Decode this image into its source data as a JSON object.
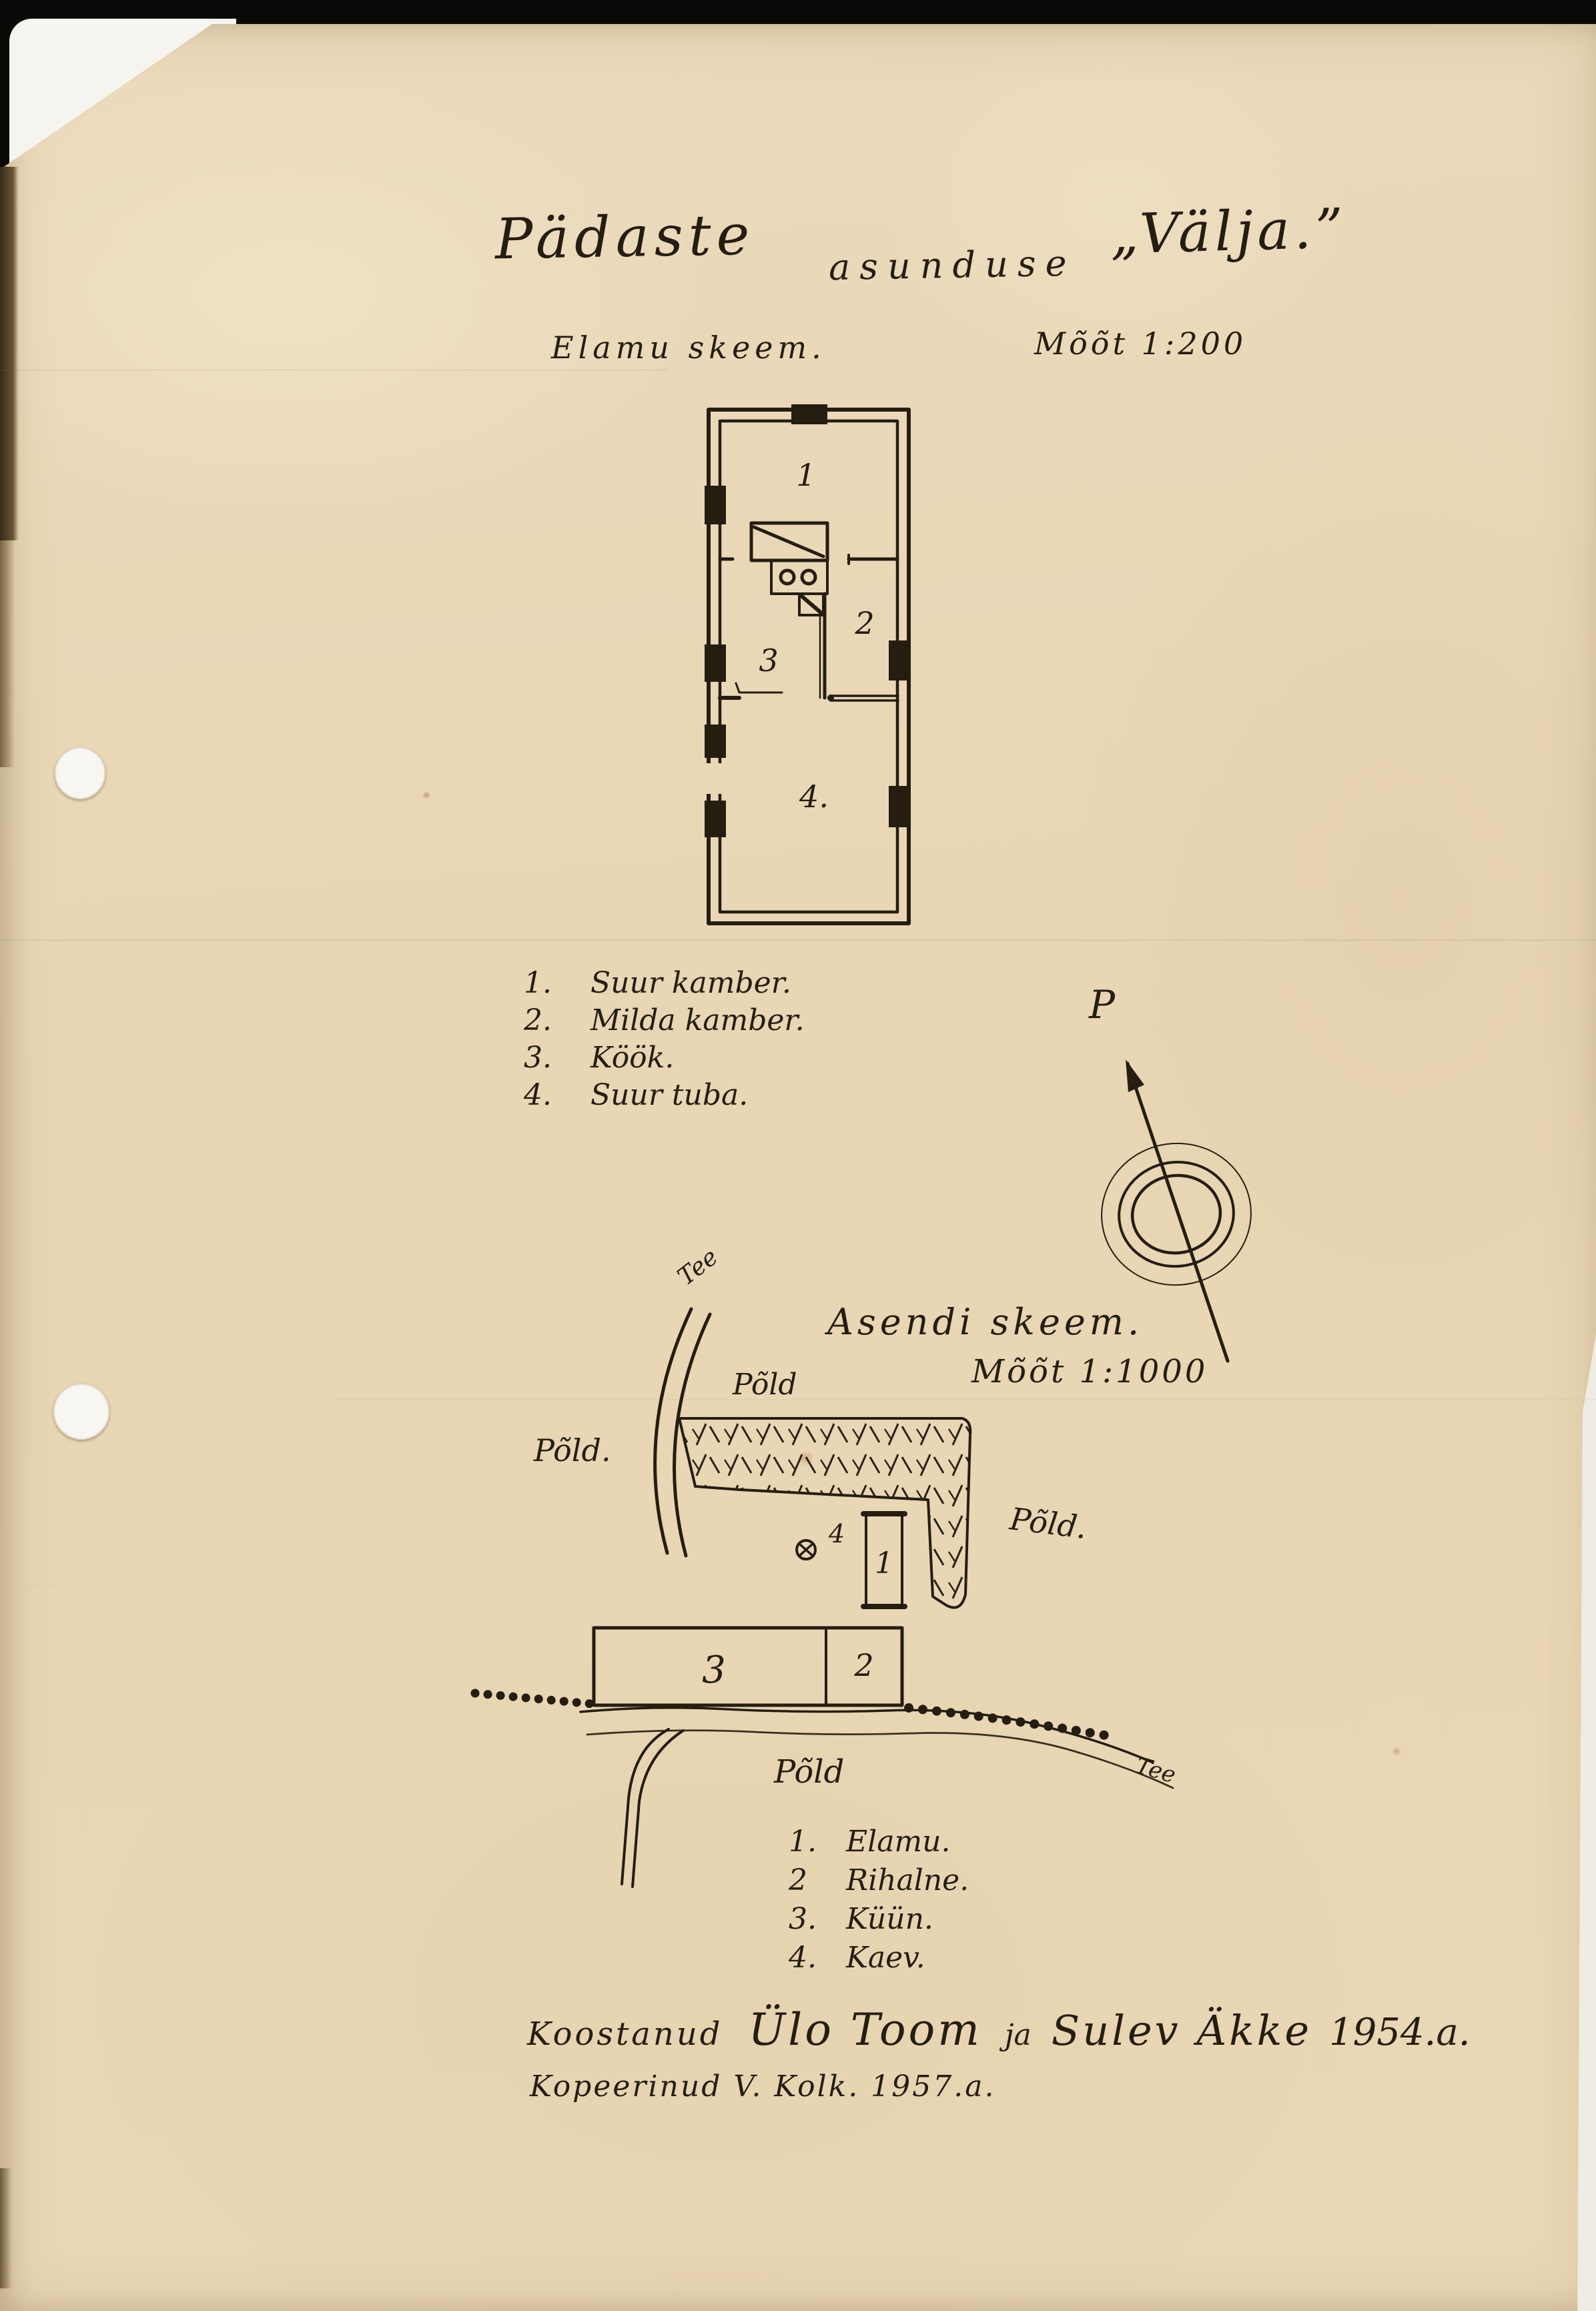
{
  "colors": {
    "paper": "#e9d7b5",
    "ink": "#261d11",
    "backing": "#f5f4ee",
    "scanner": "#0b0908"
  },
  "document": {
    "title": {
      "part1": "Pädaste",
      "part2": "asunduse",
      "part3": "„Välja.”"
    }
  },
  "floor_plan": {
    "label": "Elamu skeem.",
    "scale": "Mõõt 1:200",
    "rooms": [
      {
        "num": "1"
      },
      {
        "num": "2"
      },
      {
        "num": "3"
      },
      {
        "num": "4."
      }
    ],
    "legend": [
      {
        "num": "1.",
        "name": "Suur kamber."
      },
      {
        "num": "2.",
        "name": "Milda kamber."
      },
      {
        "num": "3.",
        "name": "Köök."
      },
      {
        "num": "4.",
        "name": "Suur tuba."
      }
    ]
  },
  "compass": {
    "north_label": "P"
  },
  "site_plan": {
    "label": "Asendi skeem.",
    "scale": "Mõõt 1:1000",
    "road_label_top": "Tee",
    "road_label_bottom": "Tee",
    "field_label_top": "Põld",
    "field_label_left": "Põld.",
    "field_label_right": "Põld.",
    "field_label_bottom": "Põld",
    "building_1": "1",
    "building_2": "2",
    "building_3": "3",
    "well_num": "4",
    "legend": [
      {
        "num": "1.",
        "name": "Elamu."
      },
      {
        "num": "2",
        "name": "Rihalne."
      },
      {
        "num": "3.",
        "name": "Küün."
      },
      {
        "num": "4.",
        "name": "Kaev."
      }
    ]
  },
  "credits": {
    "line1_prefix": "Koostanud",
    "line1_name1": "Ülo Toom",
    "line1_ja": "ja",
    "line1_name2": "Sulev Äkke",
    "line1_year": "1954.a.",
    "line2": "Kopeerinud V. Kolk. 1957.a."
  }
}
